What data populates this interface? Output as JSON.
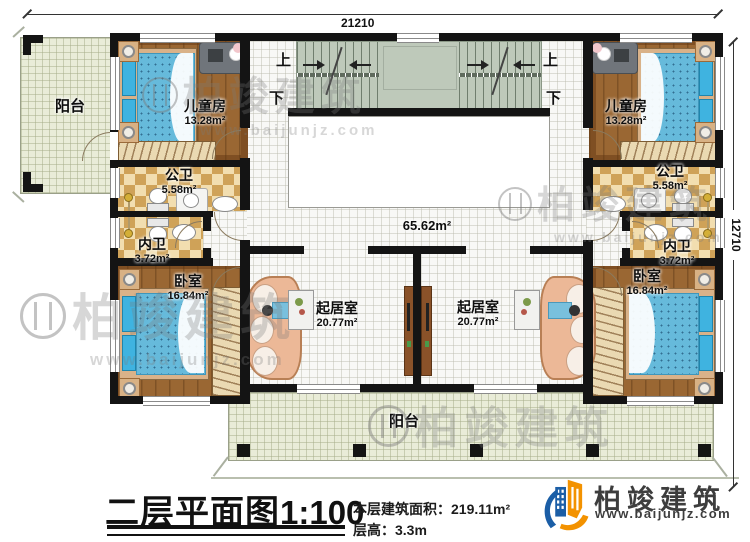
{
  "dimensions": {
    "top": "21210",
    "right": "12710"
  },
  "stairs": {
    "up": "上",
    "down": "下"
  },
  "rooms": {
    "balcony_left": {
      "name": "阳台"
    },
    "balcony_bottom": {
      "name": "阳台"
    },
    "child_left": {
      "name": "儿童房",
      "area": "13.28m²"
    },
    "child_right": {
      "name": "儿童房",
      "area": "13.28m²"
    },
    "pubbath_left": {
      "name": "公卫",
      "area": "5.58m²"
    },
    "pubbath_right": {
      "name": "公卫",
      "area": "5.58m²"
    },
    "privbath_left": {
      "name": "内卫",
      "area": "3.72m²"
    },
    "privbath_right": {
      "name": "内卫",
      "area": "3.72m²"
    },
    "bedroom_left": {
      "name": "卧室",
      "area": "16.84m²"
    },
    "bedroom_right": {
      "name": "卧室",
      "area": "16.84m²"
    },
    "living_left": {
      "name": "起居室",
      "area": "20.77m²"
    },
    "living_right": {
      "name": "起居室",
      "area": "20.77m²"
    },
    "hall": {
      "area": "65.62m²"
    }
  },
  "caption": {
    "title": "二层平面图",
    "scale": "1:100",
    "floor_area_label": "本层建筑面积：",
    "floor_area_value": "219.11m²",
    "floor_height_label": "层高：",
    "floor_height_value": "3.3m"
  },
  "brand": {
    "name": "柏竣建筑",
    "website": "www.baijunjz.com"
  },
  "watermark": {
    "name": "柏竣建筑",
    "website": "www.baijunjz.com"
  },
  "colors": {
    "wall": "#141414",
    "wood_floor": "#9a6733",
    "checker_dark": "#cfa258",
    "checker_light": "#f2deb0",
    "stair_green": "#bec9ba",
    "balcony_floor": "#e9ecd8",
    "tile": "#f8f8f6",
    "mattress_blue": "#64b9da",
    "headboard_blue": "#3fb3e0",
    "sofa": "#ecb897",
    "cabinet_brown": "#8a5229",
    "logo_blue": "#1b5ea6",
    "logo_orange": "#f39200"
  }
}
